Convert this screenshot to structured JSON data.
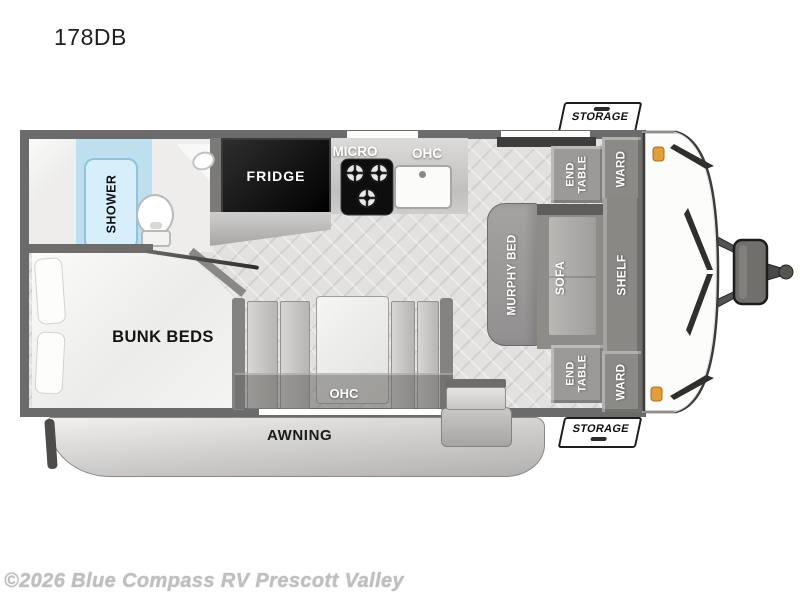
{
  "title": "178DB",
  "watermark": "©2026 Blue Compass RV Prescott Valley",
  "floorplan": {
    "bathroom": {
      "shower": "SHOWER"
    },
    "bedroom": {
      "bunk_beds": "BUNK BEDS"
    },
    "kitchen": {
      "fridge": "FRIDGE",
      "micro": "MICRO",
      "ohc": "OHC"
    },
    "living": {
      "murphy_bed": "MURPHY BED",
      "sofa": "SOFA",
      "shelf": "SHELF",
      "end_table": "END TABLE",
      "ward": "WARD"
    },
    "dinette": {
      "ohc": "OHC"
    },
    "exterior": {
      "storage": "STORAGE",
      "awning": "AWNING"
    }
  },
  "colors": {
    "wall": "#6b6b6b",
    "floor": "#e2e1df",
    "shower_glass": "#a9dcf2",
    "fridge": "#0c0c0c",
    "furniture_gray": "#96948f",
    "awning_band": "#c9c7c5",
    "marker_light": "#e09f3a",
    "label_on_dark": "#ffffff",
    "label_on_light": "#111111"
  }
}
